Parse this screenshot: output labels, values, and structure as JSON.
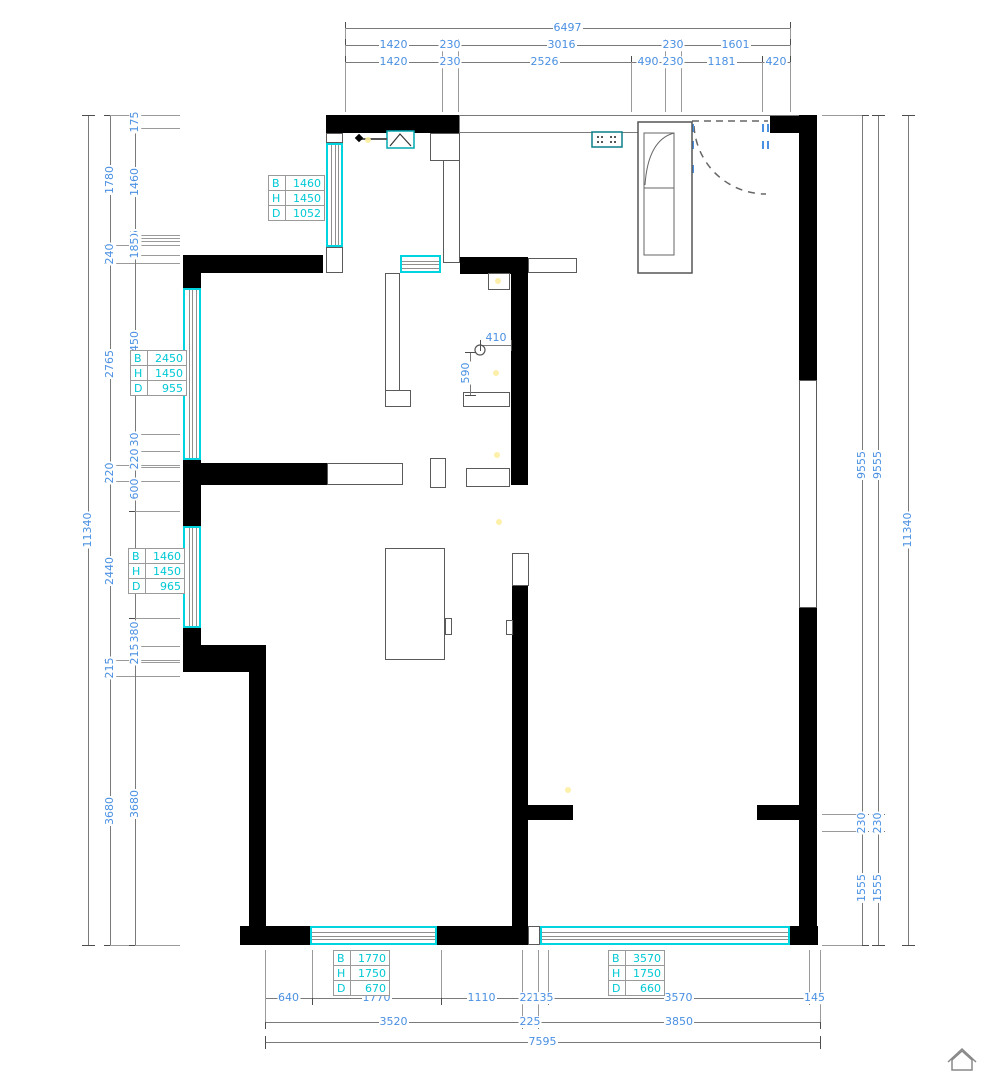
{
  "meta": {
    "type": "architectural-floor-plan",
    "units": "mm"
  },
  "colors": {
    "dim_text": "#4a90e2",
    "window_accent": "#00d4de",
    "table_text": "#00c9d4",
    "wall": "#000000",
    "lines": "#7a7a7a",
    "fixture_teal": "#00a8b0"
  },
  "dimensions": {
    "chains": [
      {
        "name": "dim-top-total",
        "dir": "h",
        "pos": 28,
        "ticks": [
          345,
          790
        ],
        "labels": [
          "6497"
        ],
        "ext_to": 112
      },
      {
        "name": "dim-top-mid",
        "dir": "h",
        "pos": 45,
        "ticks": [
          345,
          442,
          458,
          665,
          681,
          790
        ],
        "labels": [
          "1420",
          "230",
          "3016",
          "230",
          "1601"
        ],
        "ext_to": 112
      },
      {
        "name": "dim-top-inner",
        "dir": "h",
        "pos": 62,
        "ticks": [
          345,
          442,
          458,
          631,
          665,
          681,
          762,
          790
        ],
        "labels": [
          "1420",
          "230",
          "2526",
          "490",
          "230",
          "1181",
          "420"
        ],
        "ext_to": 112
      },
      {
        "name": "dim-left-total",
        "dir": "v",
        "pos": 88,
        "ticks": [
          115,
          945
        ],
        "labels": [
          "11340"
        ]
      },
      {
        "name": "dim-left-mid",
        "dir": "v",
        "pos": 110,
        "ticks": [
          115,
          245,
          263,
          465,
          481,
          660,
          676,
          945
        ],
        "labels": [
          "1780",
          "240",
          "2765",
          "220",
          "2440",
          "215",
          "3680"
        ],
        "ext_to": 180
      },
      {
        "name": "dim-left-inner",
        "dir": "v",
        "pos": 135,
        "ticks": [
          115,
          128,
          235,
          238,
          241,
          255,
          434,
          451,
          467,
          511,
          618,
          646,
          662,
          945
        ],
        "labels": [
          "175",
          "1460",
          "45",
          "40",
          "185",
          "2450",
          "230",
          "220",
          "600",
          "1460",
          "380",
          "215",
          "3680"
        ],
        "ext_to": 180
      },
      {
        "name": "dim-right-inner",
        "dir": "v",
        "pos": 862,
        "ticks": [
          115,
          814,
          831,
          945
        ],
        "labels": [
          "9555",
          "230",
          "1555"
        ],
        "ext_to": 822
      },
      {
        "name": "dim-right-mid",
        "dir": "v",
        "pos": 878,
        "ticks": [
          115,
          814,
          831,
          945
        ],
        "labels": [
          "9555",
          "230",
          "1555"
        ]
      },
      {
        "name": "dim-right-total",
        "dir": "v",
        "pos": 908,
        "ticks": [
          115,
          945
        ],
        "labels": [
          "11340"
        ]
      },
      {
        "name": "dim-bottom-inner",
        "dir": "h",
        "pos": 998,
        "ticks": [
          265,
          312,
          441,
          522,
          538,
          548,
          809,
          820
        ],
        "labels": [
          "640",
          "1770",
          "1110",
          "225",
          "135",
          "3570",
          "145"
        ],
        "ext_to": 950
      },
      {
        "name": "dim-bottom-mid",
        "dir": "h",
        "pos": 1022,
        "ticks": [
          265,
          522,
          538,
          820
        ],
        "labels": [
          "3520",
          "225",
          "3850"
        ],
        "ext_to": 952
      },
      {
        "name": "dim-bottom-total",
        "dir": "h",
        "pos": 1042,
        "ticks": [
          265,
          820
        ],
        "labels": [
          "7595"
        ]
      }
    ],
    "interior": [
      {
        "name": "dim-pipe-410",
        "label": "410",
        "dir": "h",
        "x1": 480,
        "x2": 511,
        "y": 345,
        "lx": 496,
        "ly": 338
      },
      {
        "name": "dim-pipe-590",
        "label": "590",
        "dir": "v",
        "y1": 352,
        "y2": 395,
        "x": 470,
        "lx": 466,
        "ly": 373
      }
    ]
  },
  "window_tables": [
    {
      "name": "window-spec-balcony",
      "x": 268,
      "y": 175,
      "rows": [
        [
          "B",
          "1460"
        ],
        [
          "H",
          "1450"
        ],
        [
          "D",
          "1052"
        ]
      ]
    },
    {
      "name": "window-spec-master",
      "x": 130,
      "y": 350,
      "rows": [
        [
          "B",
          "2450"
        ],
        [
          "H",
          "1450"
        ],
        [
          "D",
          "955"
        ]
      ]
    },
    {
      "name": "window-spec-bedroom2",
      "x": 128,
      "y": 548,
      "rows": [
        [
          "B",
          "1460"
        ],
        [
          "H",
          "1450"
        ],
        [
          "D",
          "965"
        ]
      ]
    },
    {
      "name": "window-spec-bedroom3",
      "x": 333,
      "y": 950,
      "rows": [
        [
          "B",
          "1770"
        ],
        [
          "H",
          "1750"
        ],
        [
          "D",
          "670"
        ]
      ]
    },
    {
      "name": "window-spec-living",
      "x": 608,
      "y": 950,
      "rows": [
        [
          "B",
          "3570"
        ],
        [
          "H",
          "1750"
        ],
        [
          "D",
          "660"
        ]
      ]
    }
  ],
  "plan": {
    "walls": [
      {
        "name": "wall-top-kitchen",
        "x": 326,
        "y": 115,
        "w": 134,
        "h": 18
      },
      {
        "name": "wall-top-right-corner",
        "x": 770,
        "y": 115,
        "w": 47,
        "h": 18
      },
      {
        "name": "wall-right-upper",
        "x": 799,
        "y": 115,
        "w": 18,
        "h": 265
      },
      {
        "name": "wall-right-lower",
        "x": 799,
        "y": 608,
        "w": 18,
        "h": 337
      },
      {
        "name": "wall-right-stub",
        "x": 757,
        "y": 805,
        "w": 44,
        "h": 15
      },
      {
        "name": "wall-left-a",
        "x": 183,
        "y": 255,
        "w": 18,
        "h": 33
      },
      {
        "name": "wall-left-b",
        "x": 183,
        "y": 460,
        "w": 18,
        "h": 66
      },
      {
        "name": "wall-left-c",
        "x": 183,
        "y": 628,
        "w": 18,
        "h": 44
      },
      {
        "name": "wall-left-corner",
        "x": 183,
        "y": 645,
        "w": 83,
        "h": 27
      },
      {
        "name": "wall-left-lower",
        "x": 249,
        "y": 668,
        "w": 17,
        "h": 277
      },
      {
        "name": "wall-bottom-left-corner",
        "x": 240,
        "y": 926,
        "w": 70,
        "h": 19
      },
      {
        "name": "wall-bottom-mid",
        "x": 437,
        "y": 926,
        "w": 91,
        "h": 19
      },
      {
        "name": "wall-bottom-right-corner",
        "x": 790,
        "y": 926,
        "w": 28,
        "h": 19
      },
      {
        "name": "wall-interior-top-left",
        "x": 183,
        "y": 255,
        "w": 140,
        "h": 18
      },
      {
        "name": "wall-interior-top-right",
        "x": 460,
        "y": 257,
        "w": 68,
        "h": 17
      },
      {
        "name": "wall-central-upper",
        "x": 511,
        "y": 257,
        "w": 17,
        "h": 228
      },
      {
        "name": "wall-central-lower",
        "x": 512,
        "y": 586,
        "w": 16,
        "h": 359
      },
      {
        "name": "wall-central-stub",
        "x": 528,
        "y": 805,
        "w": 45,
        "h": 15
      },
      {
        "name": "wall-bedroom-divider",
        "x": 201,
        "y": 463,
        "w": 126,
        "h": 22
      }
    ],
    "stubs": [
      {
        "name": "stub-balcony-top",
        "x": 326,
        "y": 133,
        "w": 17,
        "h": 10
      },
      {
        "name": "stub-balcony-bottom",
        "x": 326,
        "y": 247,
        "w": 17,
        "h": 26
      },
      {
        "name": "stub-kitchen-jog",
        "x": 430,
        "y": 133,
        "w": 30,
        "h": 28
      },
      {
        "name": "stub-kitchen-wall",
        "x": 443,
        "y": 160,
        "w": 17,
        "h": 103
      },
      {
        "name": "stub-master-partition",
        "x": 385,
        "y": 273,
        "w": 15,
        "h": 124
      },
      {
        "name": "stub-master-foot",
        "x": 385,
        "y": 390,
        "w": 26,
        "h": 17
      },
      {
        "name": "stub-switch-box",
        "x": 488,
        "y": 273,
        "w": 22,
        "h": 17
      },
      {
        "name": "stub-hall-top",
        "x": 528,
        "y": 258,
        "w": 49,
        "h": 15
      },
      {
        "name": "stub-bath-1",
        "x": 463,
        "y": 392,
        "w": 47,
        "h": 15
      },
      {
        "name": "stub-bath-2",
        "x": 466,
        "y": 468,
        "w": 44,
        "h": 19
      },
      {
        "name": "stub-divider-hollow",
        "x": 327,
        "y": 463,
        "w": 76,
        "h": 22
      },
      {
        "name": "stub-door-frame",
        "x": 430,
        "y": 458,
        "w": 16,
        "h": 30
      },
      {
        "name": "stub-central-gap",
        "x": 512,
        "y": 553,
        "w": 17,
        "h": 33
      },
      {
        "name": "stub-tab-left",
        "x": 506,
        "y": 620,
        "w": 7,
        "h": 15
      },
      {
        "name": "stub-tab-closet",
        "x": 445,
        "y": 618,
        "w": 7,
        "h": 17
      },
      {
        "name": "closet-outline",
        "x": 385,
        "y": 548,
        "w": 60,
        "h": 112
      },
      {
        "name": "right-wall-opening",
        "x": 799,
        "y": 380,
        "w": 18,
        "h": 228
      },
      {
        "name": "stub-bottom-gap",
        "x": 528,
        "y": 926,
        "w": 12,
        "h": 19
      }
    ],
    "windows": [
      {
        "name": "window-balcony",
        "x": 326,
        "y": 143,
        "w": 17,
        "h": 104
      },
      {
        "name": "window-master",
        "x": 183,
        "y": 288,
        "w": 18,
        "h": 172
      },
      {
        "name": "window-bedroom2",
        "x": 183,
        "y": 526,
        "w": 18,
        "h": 102
      },
      {
        "name": "window-pass",
        "x": 400,
        "y": 255,
        "w": 41,
        "h": 18
      },
      {
        "name": "window-bedroom3",
        "x": 310,
        "y": 926,
        "w": 127,
        "h": 19
      },
      {
        "name": "window-living",
        "x": 540,
        "y": 926,
        "w": 250,
        "h": 19
      }
    ],
    "lines": [
      {
        "name": "edge-top-outer",
        "x1": 459,
        "y1": 115,
        "x2": 799,
        "y2": 115
      },
      {
        "name": "edge-top-inner",
        "x1": 459,
        "y1": 132,
        "x2": 638,
        "y2": 132
      },
      {
        "name": "edge-top-joint",
        "x1": 459,
        "y1": 115,
        "x2": 459,
        "y2": 133
      }
    ]
  }
}
